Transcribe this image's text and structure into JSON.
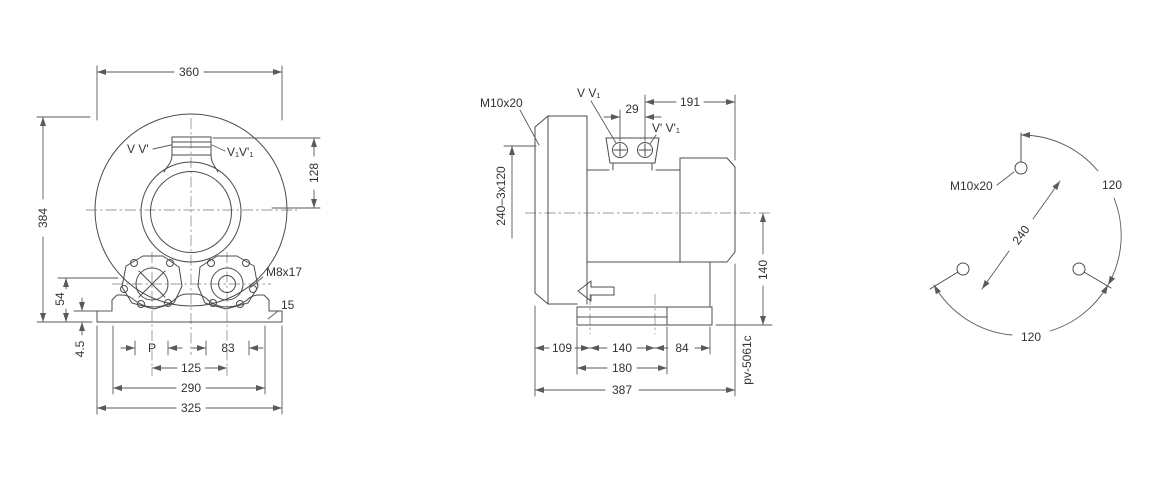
{
  "drawing": {
    "front_view": {
      "dim_width": "360",
      "dim_height": "384",
      "dim_port_height": "128",
      "label_port_left": "V V'",
      "label_port_right": "V₁V'₁",
      "label_thread": "M8x17",
      "dim_foot_thickness": "15",
      "dim_port_center_height": "54",
      "dim_foot_plate": "4.5",
      "dim_pitch": "P",
      "dim_83": "83",
      "dim_125": "125",
      "dim_290": "290",
      "dim_325": "325"
    },
    "side_view": {
      "label_thread": "M10x20",
      "label_port_v": "V V₁",
      "dim_29": "29",
      "dim_191": "191",
      "label_port_vp": "V' V'₁",
      "dim_bolt_circle": "240–3x120",
      "dim_140_right": "140",
      "dim_109": "109",
      "dim_140_bottom": "140",
      "dim_84": "84",
      "dim_180": "180",
      "dim_387": "387",
      "drawing_number": "pv-5061c"
    },
    "bolt_circle_view": {
      "label_thread": "M10x20",
      "dim_diameter": "240",
      "dim_angle_right": "120",
      "dim_angle_bottom": "120"
    },
    "colors": {
      "line": "#4c4c4c",
      "dimension": "#5a5a5a",
      "centerline": "#999999",
      "text": "#333333",
      "background": "#ffffff"
    }
  }
}
